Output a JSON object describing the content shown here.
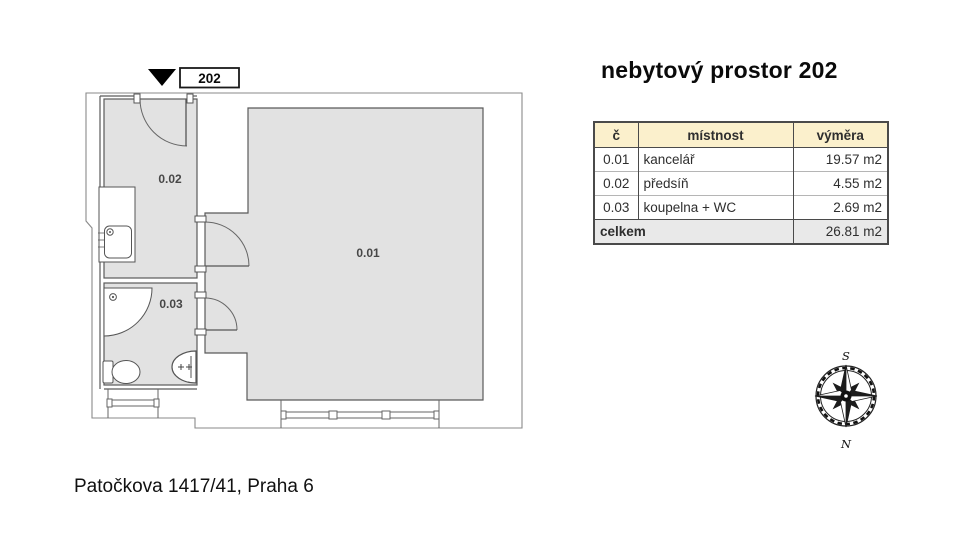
{
  "title": "nebytový prostor 202",
  "floorplan": {
    "marker_label": "202",
    "room_labels": {
      "office": "0.01",
      "hall": "0.02",
      "bath": "0.03"
    }
  },
  "table": {
    "columns": [
      "č",
      "místnost",
      "výměra"
    ],
    "rows": [
      {
        "num": "0.01",
        "name": "kancelář",
        "area": "19.57 m2"
      },
      {
        "num": "0.02",
        "name": "předsíň",
        "area": "4.55 m2"
      },
      {
        "num": "0.03",
        "name": "koupelna + WC",
        "area": "2.69 m2"
      }
    ],
    "total": {
      "label": "celkem",
      "area": "26.81 m2"
    }
  },
  "compass": {
    "top": "S",
    "bottom": "N"
  },
  "address": "Patočkova 1417/41, Praha 6",
  "colors": {
    "room_fill": "#e2e2e2",
    "wall_line": "#5a5a5a",
    "boundary_line": "#8a8a8a",
    "table_header_bg": "#fbf0cc",
    "table_total_bg": "#e9e9e9",
    "marker_fill": "#000000"
  }
}
